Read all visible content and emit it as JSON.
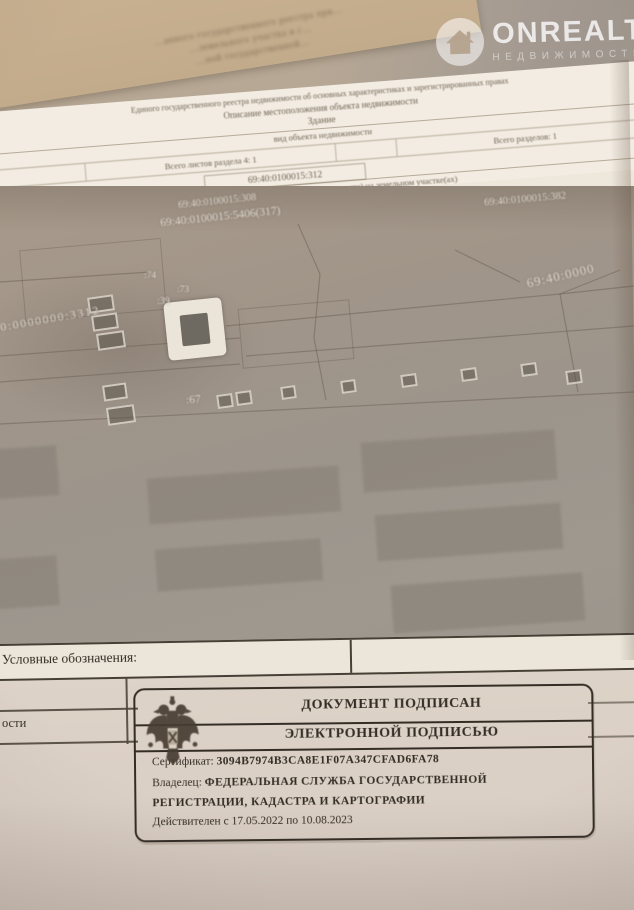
{
  "watermark": {
    "brand": "ONREALT",
    "subtitle": "НЕДВИЖИМОСТЬ",
    "icon": "house-icon"
  },
  "background_page": {
    "lines": [
      "…анного государственного реестра при…",
      "…земельного участка в г…",
      "…ной государственной…"
    ]
  },
  "document": {
    "header": {
      "registry_line": "Единого государственного реестра недвижимости об основных характеристиках и зарегистрированных правах",
      "description_line": "Описание местоположения объекта недвижимости",
      "object_type": "Здание",
      "object_type_caption": "вид объекта недвижимости",
      "sheets_total": "Всего листов раздела 4: 1",
      "sections_total": "Всего разделов: 1",
      "cadastral_number": "69:40:0100015:312",
      "map_caption": "недвижимости (части объекта недвижимости) на земельном участке(ах)"
    },
    "map": {
      "labels": [
        {
          "text": "69:40:0100015:308"
        },
        {
          "text": "69:40:0100015:5406(317)"
        },
        {
          "text": "69:40:0100015:382"
        },
        {
          "text": "69:40:0000"
        },
        {
          "text": "40:0000000:3312"
        },
        {
          "text": ":74"
        },
        {
          "text": ":73"
        },
        {
          "text": ":39"
        },
        {
          "text": ":67"
        }
      ]
    },
    "legend": {
      "title": "Условные обозначения:"
    },
    "page_edge_fragment": "ости",
    "stamp": {
      "line1": "ДОКУМЕНТ ПОДПИСАН",
      "line2": "ЭЛЕКТРОННОЙ ПОДПИСЬЮ",
      "certificate_label": "Сертификат:",
      "certificate_value": "3094B7974B3CA8E1F07A347CFAD6FA78",
      "owner_label": "Владелец:",
      "owner_line1": "ФЕДЕРАЛЬНАЯ СЛУЖБА ГОСУДАРСТВЕННОЙ",
      "owner_line2": "РЕГИСТРАЦИИ, КАДАСТРА И КАРТОГРАФИИ",
      "validity": "Действителен  с 17.05.2022 по 10.08.2023"
    }
  },
  "colors": {
    "paper": "#f0eadf",
    "map_tone": "#a09488",
    "stamp_ink": "#332d26",
    "watermark": "#ffffff"
  }
}
